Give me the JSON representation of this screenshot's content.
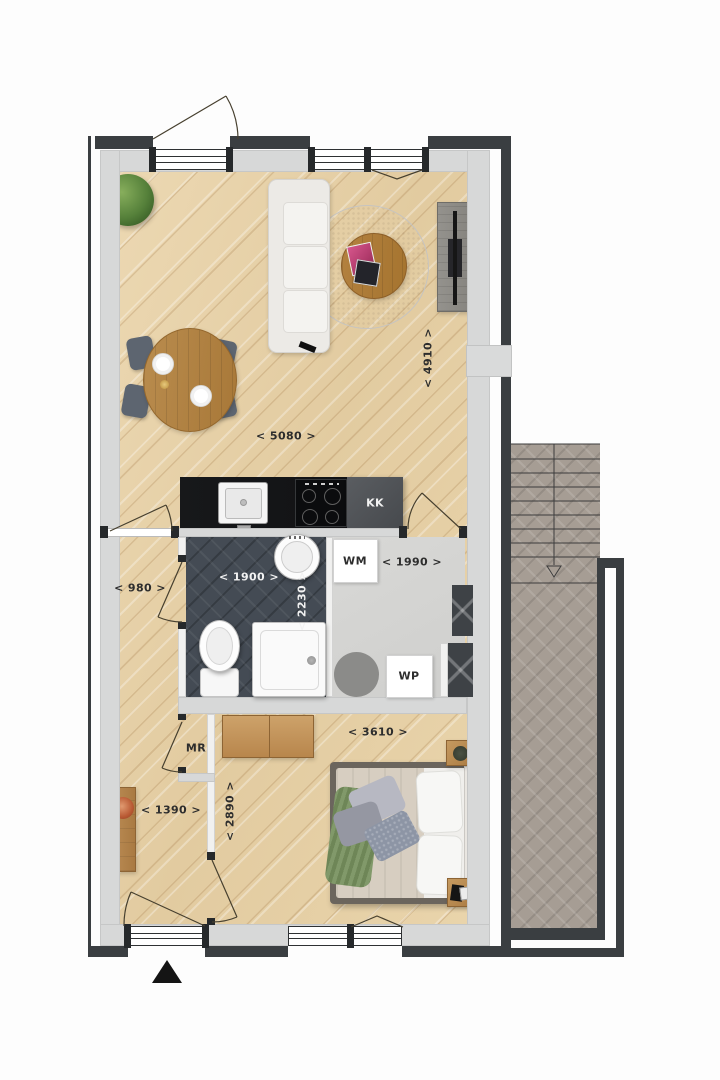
{
  "plan": {
    "rooms": {
      "living": {
        "width_label": "< 5080 >",
        "depth_label": "< 4910 >"
      },
      "hall_top": {
        "width_label": "< 980 >"
      },
      "bathroom": {
        "width_label": "< 1900 >",
        "depth_label": "< 2230 >"
      },
      "utility": {
        "width_label": "< 1990 >"
      },
      "bedroom": {
        "width_label": "< 3610 >",
        "depth_label": "< 2890 >"
      },
      "hall_bottom": {
        "width_label": "< 1390 >"
      }
    },
    "fixtures": {
      "kitchen_unit_label": "KK",
      "washing_machine_label": "WM",
      "heat_pump_label": "WP",
      "meter_cupboard_label": "MR"
    },
    "colors": {
      "wall_dark": "#3a3e41",
      "wall_inner": "#d7d8d8",
      "floor_wood": "#e6d2ab",
      "bathroom_tile": "#444b54",
      "stair_tile": "#a69d94",
      "utility_floor": "#d4d4d2"
    }
  }
}
